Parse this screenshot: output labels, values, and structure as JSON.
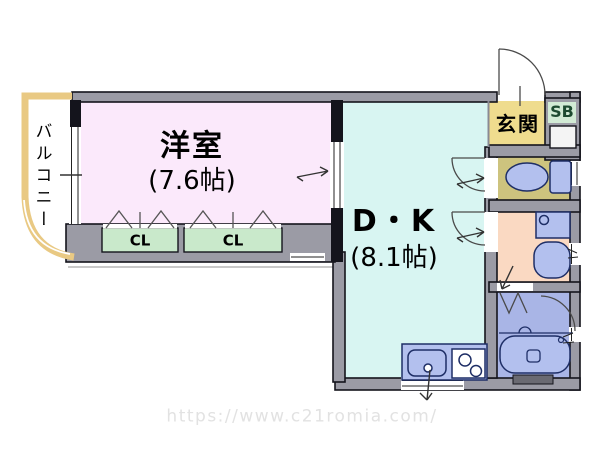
{
  "plan_title": "1DK apartment floor plan",
  "rooms": {
    "western": {
      "label": "洋室",
      "size": "(7.6帖)"
    },
    "dk": {
      "label": "D・K",
      "size": "(8.1帖)"
    },
    "entrance": {
      "label": "玄関"
    },
    "balcony": {
      "label": "バルコニー"
    },
    "shoebox": {
      "label": "SB"
    },
    "closet_left": {
      "label": "CL"
    },
    "closet_right": {
      "label": "CL"
    }
  },
  "watermark": {
    "text": "https://www.c21romia.com/"
  },
  "colors": {
    "wall_fill": "#9b9ba5",
    "western_room": "#fbe9fb",
    "dining_kitchen": "#d8f5f2",
    "entrance": "#efdc8e",
    "toilet_room": "#cdc37e",
    "washroom": "#fad9c2",
    "bathroom": "#a9b5e6",
    "closet": "#c9e9cb",
    "shoebox": "#d2ebd5",
    "balcony_outline": "#e9c983",
    "fixture_fill": "#b3c0ee",
    "fixture_stroke": "#1e2e66"
  }
}
